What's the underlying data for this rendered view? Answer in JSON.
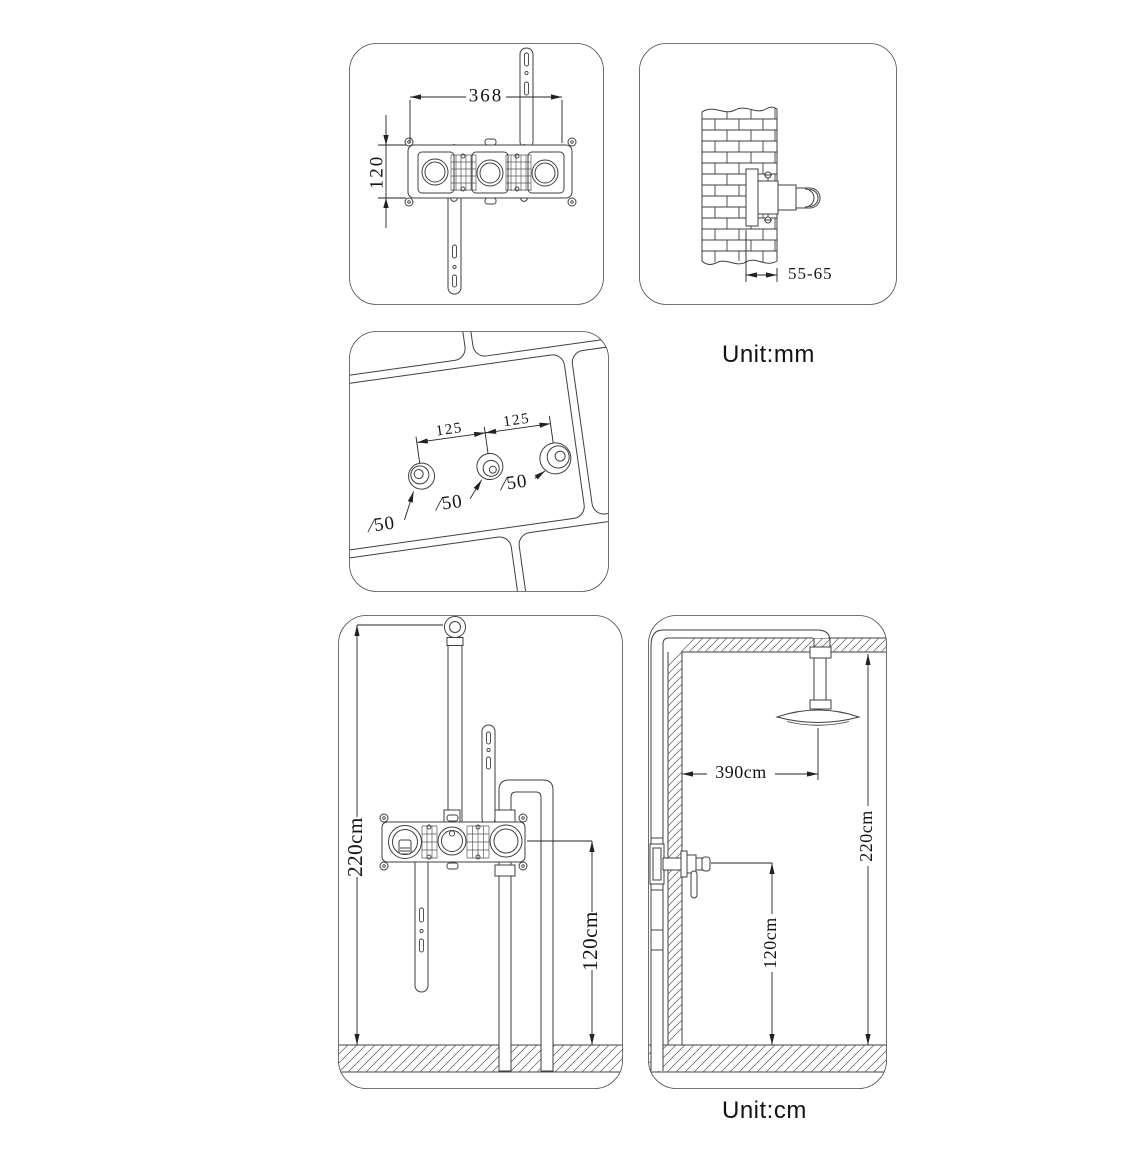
{
  "colors": {
    "ink": "#3f3f3f",
    "dim_ink": "#222222",
    "text_ink": "#141414"
  },
  "unit_labels": {
    "top": "Unit:mm",
    "bottom": "Unit:cm"
  },
  "panels": {
    "valve_front": {
      "dim_width": "368",
      "dim_height": "120"
    },
    "wall_section": {
      "dim_depth": "55-65"
    },
    "wall_holes": {
      "dim_spacing_left": "125",
      "dim_spacing_right": "125",
      "dim_hole_left": "∕50",
      "dim_hole_mid": "∕50",
      "dim_hole_right": "∕50"
    },
    "rough_in": {
      "dim_total_height": "220cm",
      "dim_valve_height": "120cm"
    },
    "room": {
      "dim_head_offset": "390cm",
      "dim_ceiling_height": "220cm",
      "dim_valve_height": "120cm"
    }
  }
}
